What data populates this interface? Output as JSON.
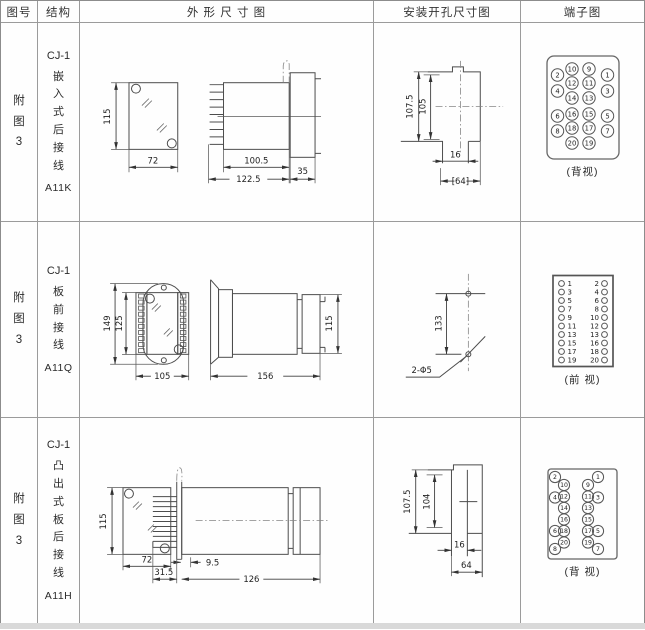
{
  "colors": {
    "line": "#4c4c4c",
    "table_border": "#8c8c8c",
    "text": "#2b2b2b",
    "footer_strip": "#d9d9d9"
  },
  "header": {
    "cells": [
      "图号",
      "结构",
      "外 形 尺 寸 图",
      "安装开孔尺寸图",
      "端子图"
    ]
  },
  "rows": [
    {
      "fig": "附图3",
      "series": "CJ-1",
      "mount_type": "嵌入式后接线",
      "model": "A11K",
      "outline": {
        "front_h": "115",
        "front_w": "72",
        "body_len": "100.5",
        "overall_len": "122.5",
        "flange_d": "35"
      },
      "mounting": {
        "outer_h": "107.5",
        "inner_h": "105",
        "slot_w": "16",
        "hole_w": "[64]"
      },
      "terminal": {
        "view_label": "(背视)",
        "inner_pairs": [
          [
            "10",
            "9"
          ],
          [
            "12",
            "11"
          ],
          [
            "14",
            "13"
          ],
          [
            "16",
            "15"
          ],
          [
            "18",
            "17"
          ],
          [
            "20",
            "19"
          ]
        ],
        "outer_left": [
          "2",
          "4",
          "6",
          "8"
        ],
        "outer_right": [
          "1",
          "3",
          "5",
          "7"
        ]
      }
    },
    {
      "fig": "附图3",
      "series": "CJ-1",
      "mount_type": "板前接线",
      "model": "A11Q",
      "outline": {
        "outer_h": "149",
        "inner_h": "125",
        "front_w": "105",
        "side_len": "156",
        "side_h": "115"
      },
      "mounting": {
        "hole_dist": "133",
        "hole_spec": "2-Φ5"
      },
      "terminal": {
        "view_label": "(前 视)",
        "rows": [
          [
            "1",
            "2"
          ],
          [
            "3",
            "4"
          ],
          [
            "5",
            "6"
          ],
          [
            "7",
            "8"
          ],
          [
            "9",
            "10"
          ],
          [
            "11",
            "12"
          ],
          [
            "13",
            "13"
          ],
          [
            "15",
            "16"
          ],
          [
            "17",
            "18"
          ],
          [
            "19",
            "20"
          ]
        ]
      }
    },
    {
      "fig": "附图3",
      "series": "CJ-1",
      "mount_type": "凸出式板后接线",
      "model": "A11H",
      "outline": {
        "front_h": "115",
        "front_w": "72",
        "pin_len": "31.5",
        "offset": "9.5",
        "body_len": "126"
      },
      "mounting": {
        "outer_h": "107.5",
        "inner_h": "104",
        "slot_w": "16",
        "hole_w": "64"
      },
      "terminal": {
        "view_label": "(背 视)",
        "outer_left": [
          "2",
          "4",
          "6",
          "8"
        ],
        "inner_left": [
          "10",
          "12",
          "14",
          "16",
          "18",
          "20"
        ],
        "inner_right": [
          "9",
          "11",
          "13",
          "15",
          "17",
          "19"
        ],
        "outer_right": [
          "1",
          "3",
          "5",
          "7"
        ]
      }
    }
  ]
}
